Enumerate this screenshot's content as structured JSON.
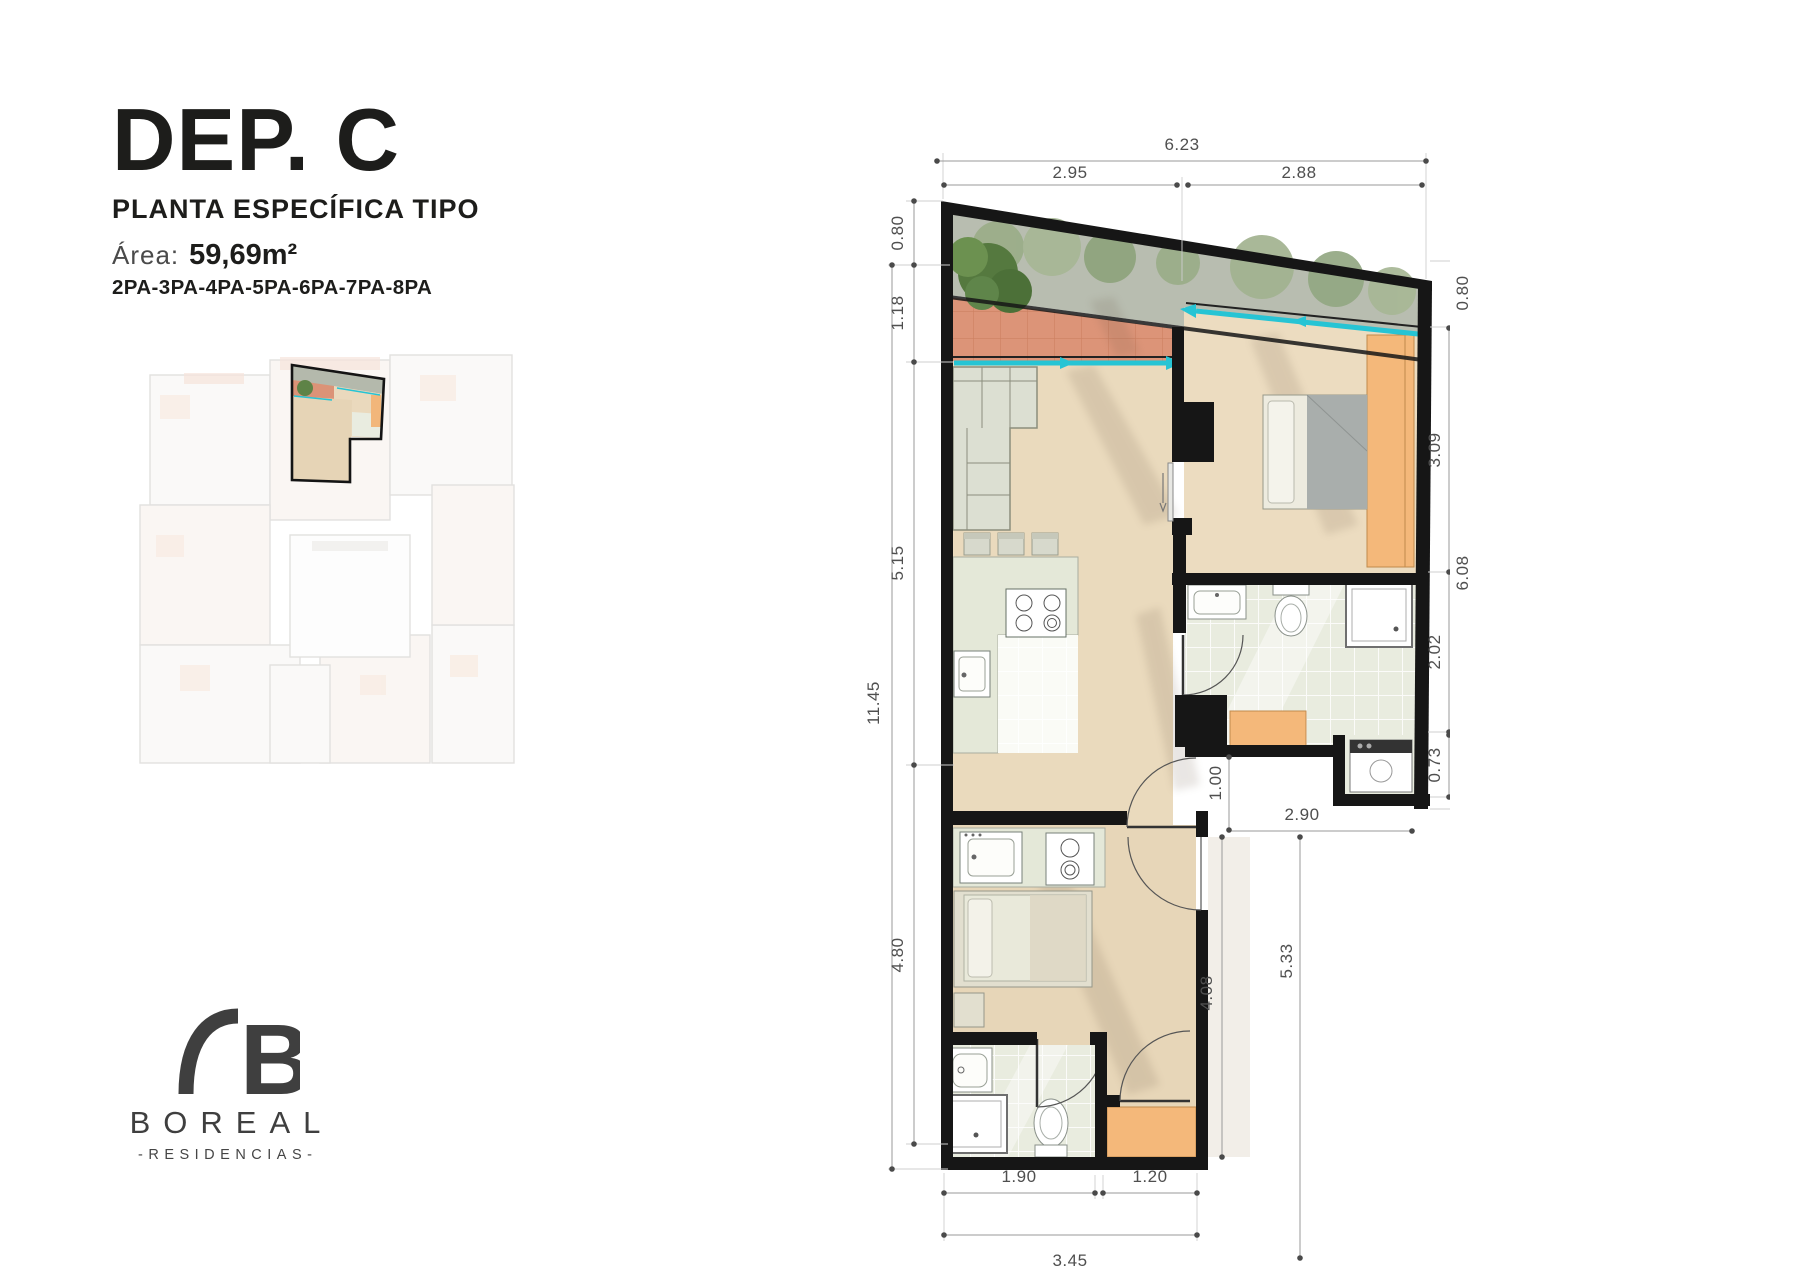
{
  "header": {
    "title": "DEP. C",
    "subtitle": "PLANTA ESPECÍFICA TIPO",
    "area_label": "Área:",
    "area_value": "59,69m²",
    "units": "2PA-3PA-4PA-5PA-6PA-7PA-8PA"
  },
  "logo": {
    "monogram": "B",
    "brand": "BOREAL",
    "tagline": "-RESIDENCIAS-"
  },
  "plan": {
    "dims": {
      "top_total": "6.23",
      "top_left": "2.95",
      "top_right": "2.88",
      "left_0": "0.80",
      "left_1": "1.18",
      "left_2": "5.15",
      "left_3": "4.80",
      "left_total": "11.45",
      "right_0": "0.80",
      "right_1": "3.09",
      "right_total": "6.08",
      "right_2": "2.02",
      "right_3": "0.73",
      "mid_hall": "1.00",
      "mid_corridor": "2.90",
      "mid_inner": "4.08",
      "mid_total": "5.33",
      "bottom_left": "1.90",
      "bottom_right": "1.20",
      "bottom_total": "3.45"
    }
  },
  "colors": {
    "wall": "#161616",
    "planter": "#b8bdb0",
    "terrace_tile": "#dc9478",
    "window_cyan": "#26c4d4",
    "wood_floor": "#eadabd",
    "cabinet_orange": "#f4b87a",
    "dim_text": "#4f4f4f",
    "brand_gray": "#3f3f3f"
  }
}
